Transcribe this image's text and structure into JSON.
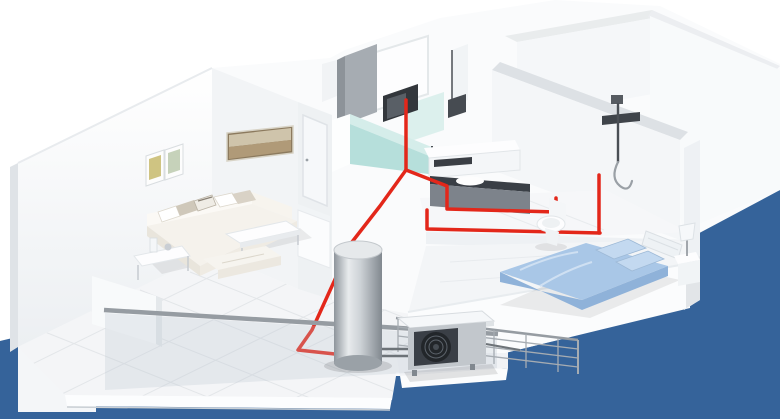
{
  "scene": {
    "type": "3d-architectural-render",
    "subject": "Isometric cutaway apartment model showing red heating pipework, a hot water cylinder and an outdoor heat pump unit on a blue backdrop",
    "rooms": [
      "living-room",
      "balcony",
      "kitchen",
      "bathroom",
      "shower-area",
      "bedroom",
      "empty-rooms"
    ],
    "objects": [
      "sectional-sofa",
      "coffee-table",
      "ottoman",
      "side-table",
      "wall-art-frames",
      "framed-painting",
      "kitchen-cabinets",
      "microwave",
      "washing-machine",
      "bathroom-vanity",
      "wash-basin",
      "toilet",
      "shower-set",
      "double-bed",
      "pillows",
      "headboard",
      "nightstand",
      "table-lamp",
      "glass-balcony-railing",
      "metal-railing-grid",
      "hot-water-cylinder",
      "outdoor-heat-pump-unit",
      "red-heating-pipes",
      "interior-door",
      "tall-cabinet"
    ]
  },
  "colors": {
    "backdrop_blue": "#35639a",
    "wall_bright": "#fafbfc",
    "wall_shade": "#eef1f4",
    "wall_dark": "#dfe3e7",
    "floor_tile_line": "#e3e6e9",
    "pipe_red": "#e3271a",
    "kitchen_teal": "#b6dfdb",
    "kitchen_teal_top": "#d5edea",
    "bed_blue": "#a9c7e7",
    "bed_blue_dark": "#8fb2d9",
    "bed_blue_light": "#c3d9f0",
    "appliance_dark": "#3a3f46",
    "metal_silver": "#c2c7cc",
    "glass_gray": "#b9c4cf",
    "sofa_cream": "#f5f2ec",
    "art_brown": "#b09a78"
  }
}
